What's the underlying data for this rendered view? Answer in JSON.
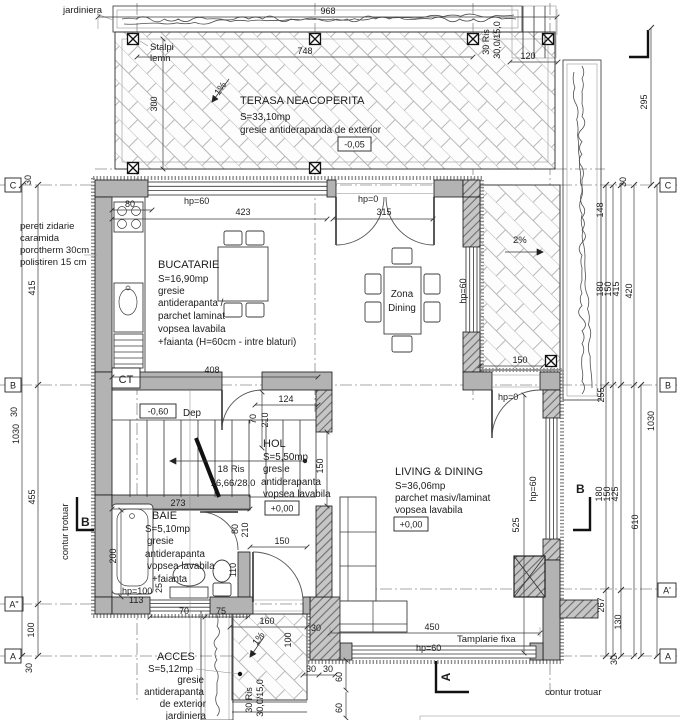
{
  "rooms": {
    "terasa": {
      "name": "TERASA NEACOPERITA",
      "area": "S=33,10mp",
      "finish": "gresie antiderapanda de exterior",
      "level": "-0,05"
    },
    "bucatarie": {
      "name": "BUCATARIE",
      "area": "S=16,90mp",
      "f1": "gresie",
      "f2": "antiderapanta /",
      "f3": "parchet laminat",
      "f4": "vopsea lavabila",
      "f5": "+faianta (H=60cm - intre blaturi)"
    },
    "dining": {
      "n1": "Zona",
      "n2": "Dining"
    },
    "dep": {
      "name": "Dep",
      "level": "-0,60"
    },
    "hol": {
      "name": "HOL",
      "area": "S=5,50mp",
      "f1": "gresie",
      "f2": "antiderapanta",
      "f3": "vopsea lavabila",
      "level": "+0,00"
    },
    "baie": {
      "name": "BAIE",
      "area": "S=5,10mp",
      "f1": "gresie",
      "f2": "antiderapanta",
      "f3": "vopsea lavabila",
      "f4": "+faianta"
    },
    "living": {
      "name": "LIVING & DINING",
      "area": "S=36,06mp",
      "f1": "parchet masiv/laminat",
      "f2": "vopsea lavabila",
      "level": "+0,00"
    },
    "acces": {
      "name": "ACCES",
      "area": "S=5,12mp",
      "f1": "gresie",
      "f2": "antiderapanta",
      "f3": "de exterior",
      "f4": "jardiniera"
    }
  },
  "notes": {
    "jardiniera": "jardiniera",
    "stalpi1": "Stalpi",
    "stalpi2": "lemn",
    "wall_note1": "pereti zidarie",
    "wall_note2": "caramida",
    "wall_note3": "porotherm 30cm",
    "wall_note4": "polistiren 15 cm",
    "ct": "CT",
    "int_stairs1": "18 Ris",
    "int_stairs2": "16,66/28,0",
    "ext_stairs1": "30 Ris",
    "ext_stairs2": "30,0/15,0",
    "tamplarie": "Tamplarie fixa",
    "contur": "contur trotuar",
    "slope_terasa": "1%",
    "slope_lateral": "2%",
    "slope_acces": "1%"
  },
  "openings": {
    "hp60": "hp=60",
    "hp0": "hp=0",
    "hp100": "hp=100"
  },
  "grid": {
    "c": "C",
    "b": "B",
    "a2": "A\"",
    "a1": "A'",
    "a": "A"
  },
  "dims": {
    "d968": "968",
    "d748": "748",
    "d300": "300",
    "d120": "120",
    "d423": "423",
    "d315": "315",
    "d80": "80",
    "d408": "408",
    "d124": "124",
    "d70": "70",
    "d210": "210",
    "d150": "150",
    "d273": "273",
    "d110": "110",
    "d25": "25",
    "d200": "200",
    "d113": "113",
    "d75": "75",
    "d160": "160",
    "d100": "100",
    "d30": "30",
    "d60": "60",
    "d450": "450",
    "d525": "525",
    "d295": "295",
    "d148": "148",
    "d180": "180",
    "d415": "415",
    "d420": "420",
    "d255": "255",
    "d1030": "1030",
    "d425": "425",
    "d610": "610",
    "d267": "267",
    "d130": "130",
    "d455": "455"
  },
  "colors": {
    "wall_gray": "#b3b3b3",
    "line": "#1c1c1c",
    "paving_joint": "#b8b8b8"
  }
}
